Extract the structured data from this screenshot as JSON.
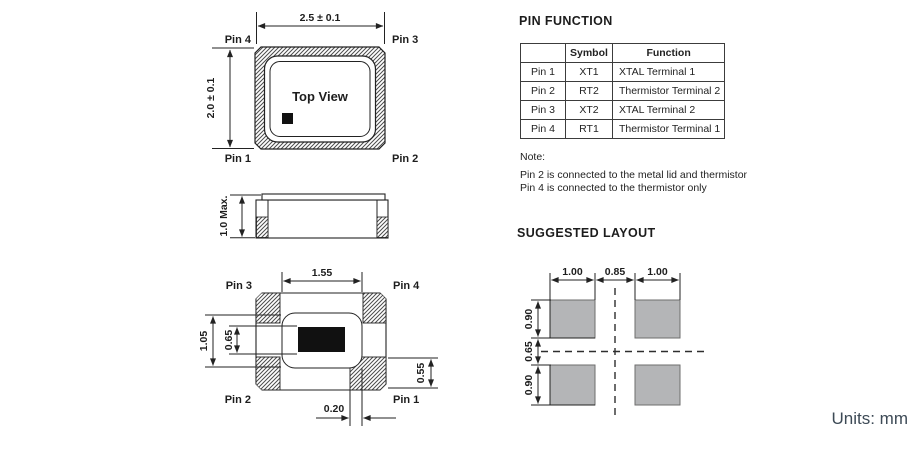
{
  "units_label": "Units: mm",
  "colors": {
    "line": "#222222",
    "pad_gray": "#b4b5b7",
    "units_text": "#3d4a56"
  },
  "top_view": {
    "label": "Top View",
    "dim_width": "2.5 ± 0.1",
    "dim_height": "2.0 ± 0.1",
    "pin_top_left": "Pin 4",
    "pin_top_right": "Pin 3",
    "pin_bottom_left": "Pin 1",
    "pin_bottom_right": "Pin 2"
  },
  "side_view": {
    "dim_height": "1.0 Max."
  },
  "bottom_view": {
    "dim_width": "1.55",
    "dim_body_height": "1.05",
    "dim_opening_height": "0.65",
    "dim_pad_height": "0.55",
    "dim_pad_offset": "0.20",
    "pin_top_left": "Pin 3",
    "pin_top_right": "Pin 4",
    "pin_bottom_left": "Pin 2",
    "pin_bottom_right": "Pin 1"
  },
  "pin_function": {
    "title": "PIN FUNCTION",
    "headers": [
      "",
      "Symbol",
      "Function"
    ],
    "rows": [
      [
        "Pin 1",
        "XT1",
        "XTAL Terminal 1"
      ],
      [
        "Pin 2",
        "RT2",
        "Thermistor Terminal 2"
      ],
      [
        "Pin 3",
        "XT2",
        "XTAL Terminal 2"
      ],
      [
        "Pin 4",
        "RT1",
        "Thermistor Terminal 1"
      ]
    ],
    "note_title": "Note:",
    "note_line1": "Pin 2 is connected to the metal lid and thermistor",
    "note_line2": "Pin 4 is connected to the thermistor only"
  },
  "suggested_layout": {
    "title": "SUGGESTED LAYOUT",
    "dim_pad_width_left": "1.00",
    "dim_gap": "0.85",
    "dim_pad_width_right": "1.00",
    "dim_pad_height_top": "0.90",
    "dim_row_gap": "0.65",
    "dim_pad_height_bottom": "0.90"
  }
}
